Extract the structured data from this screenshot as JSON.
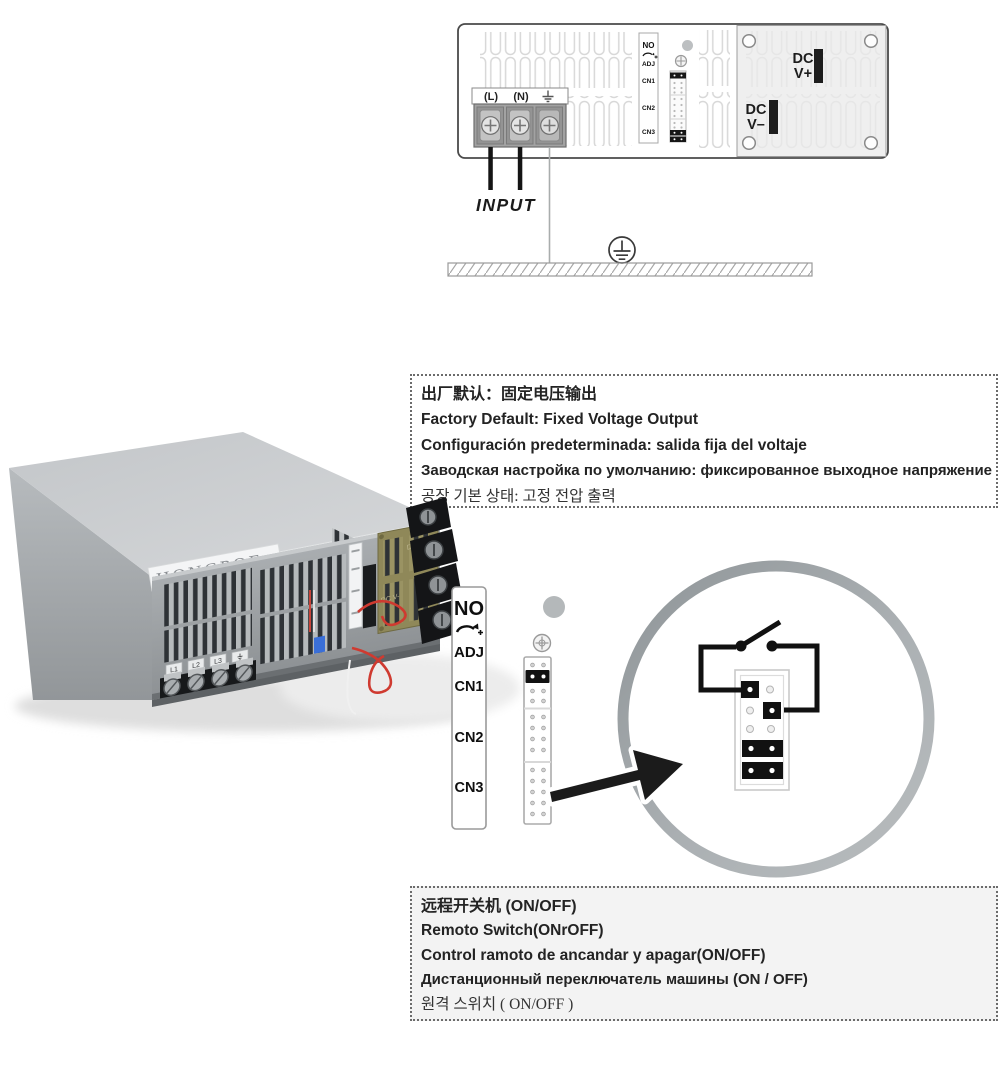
{
  "colors": {
    "wire_red": "#cf3a30",
    "ring_gray": "#a5aaad",
    "pcb_olive": "#8f8859",
    "panel_gray": "#efefef"
  },
  "top_diagram": {
    "terminal_labels": {
      "live": "(L)",
      "neutral": "(N)"
    },
    "input_label": "INPUT",
    "connector_strip": {
      "no": "NO",
      "adj": "ADJ",
      "cn1": "CN1",
      "cn2": "CN2",
      "cn3": "CN3"
    },
    "dc_positive": {
      "line1": "DC",
      "line2": "V+"
    },
    "dc_negative": {
      "line1": "DC",
      "line2": "V–"
    }
  },
  "factory_default_box": {
    "lines": [
      "出厂默认：固定电压输出",
      "Factory Default: Fixed Voltage Output",
      "Configuración predeterminada: salida fija del voltaje",
      "Заводская настройка по умолчанию: фиксированное выходное напряжение",
      "공장 기본 상태: 고정 전압 출력"
    ]
  },
  "psu_photo": {
    "brand": "HONGPOE",
    "pcb_dc_positive": "DC V+",
    "pcb_dc_negative": "DC V-",
    "ac_terminal_tags": [
      "L1",
      "L2",
      "L3"
    ]
  },
  "remote_switch_diagram": {
    "labels": {
      "no": "NO",
      "adj": "ADJ",
      "cn1": "CN1",
      "cn2": "CN2",
      "cn3": "CN3"
    }
  },
  "remote_switch_box": {
    "lines": [
      "远程开关机  (ON/OFF)",
      "Remoto Switch(ONrOFF)",
      "Control ramoto de ancandar y apagar(ON/OFF)",
      "Дистанционный переключатель машины (ON / OFF)",
      "원격 스위치 ( ON/OFF )"
    ]
  }
}
